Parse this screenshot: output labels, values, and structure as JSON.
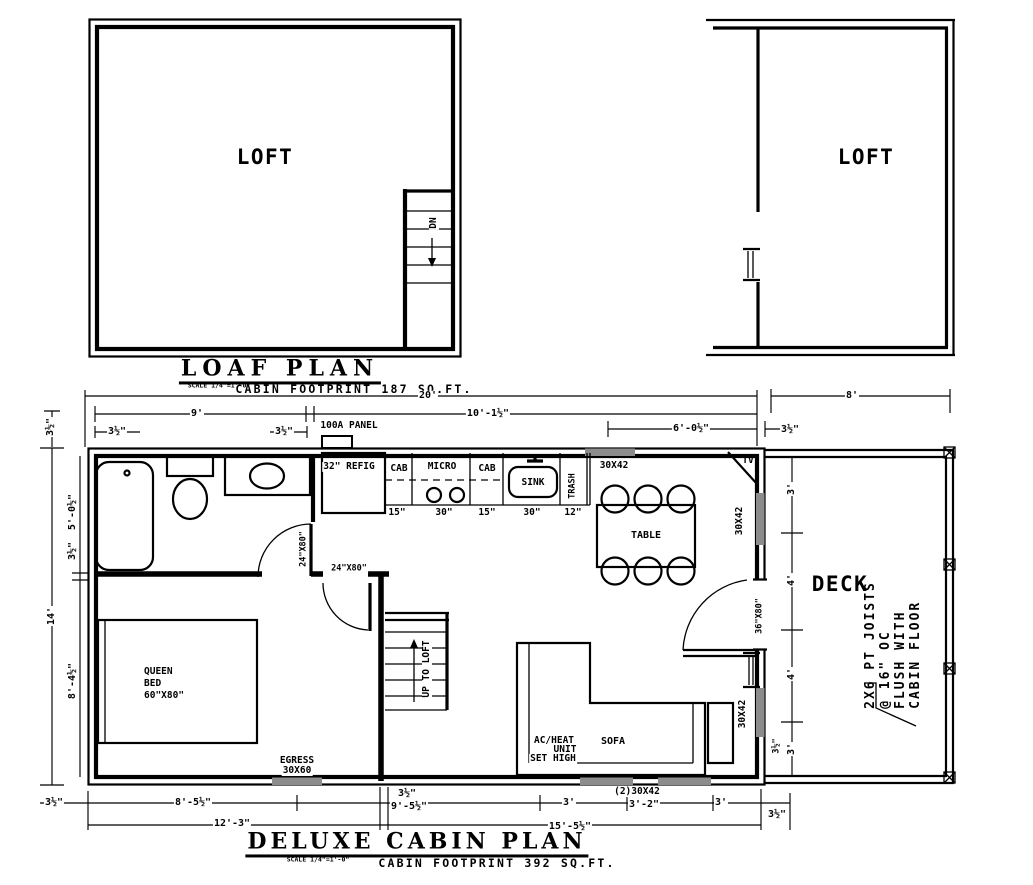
{
  "titles": {
    "loft": {
      "title": "LOAF PLAN",
      "scale": "SCALE 1/4\"=1'-0\"",
      "footprint": "CABIN FOOTPRINT 187 SQ.FT."
    },
    "cabin": {
      "title": "DELUXE CABIN PLAN",
      "scale": "SCALE 1/4\"=1'-0\"",
      "footprint": "CABIN FOOTPRINT 392 SQ.FT."
    }
  },
  "rooms": {
    "loft": "LOFT",
    "deck": "DECK",
    "table": "TABLE",
    "sofa": "SOFA"
  },
  "labels": {
    "dn": "DN",
    "up_to_loft": "UP TO LOFT",
    "tv": "TV",
    "panel": "100A PANEL",
    "refig": "32\" REFIG",
    "cab": "CAB",
    "micro": "MICRO",
    "sink": "SINK",
    "trash": "TRASH",
    "queen1": "QUEEN",
    "queen2": "BED",
    "queen3": "60\"X80\"",
    "egress1": "EGRESS",
    "egress2": "30X60",
    "ac1": "AC/HEAT",
    "ac2": "UNIT",
    "ac3": "SET HIGH",
    "door24": "24\"X80\"",
    "door36": "36\"X80\"",
    "win3042": "30X42",
    "win2x3042": "(2)30X42",
    "note1": "2X6 PT JOISTS",
    "note2": "@ 16\" OC",
    "note3": "FLUSH WITH",
    "note4": "CABIN FLOOR"
  },
  "dims": {
    "d20": "20'",
    "d9": "9'",
    "d10": "10'-1½\"",
    "d35": "3½\"",
    "d6": "6'-0½\"",
    "d8": "8'",
    "d5": "5'-0½\"",
    "d14": "14'",
    "d84": "8'-4½\"",
    "d85": "8'-5½\"",
    "d95": "9'-5½\"",
    "d123": "12'-3\"",
    "d155": "15'-5½\"",
    "d3": "3'",
    "d32": "3'-2\"",
    "d4": "4'",
    "k15": "15\"",
    "k30": "30\"",
    "k12": "12\""
  },
  "colors": {
    "ink": "#000000",
    "window_fill": "#8c8c8c"
  }
}
